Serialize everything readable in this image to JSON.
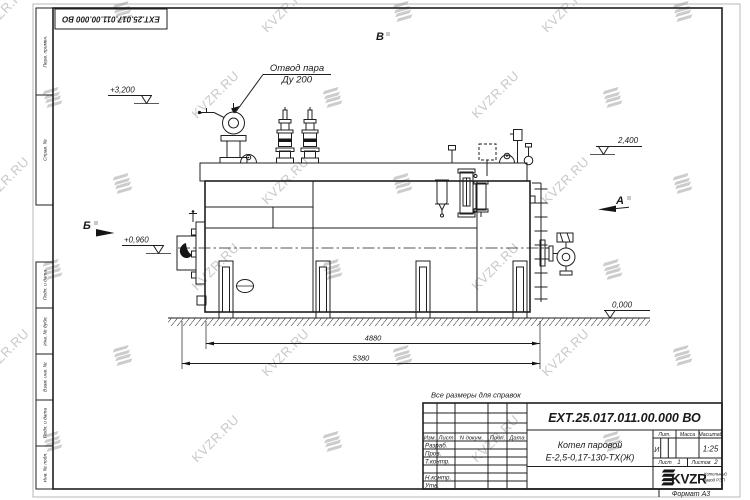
{
  "sheet": {
    "doc_number": "ЕХТ.25.017.011.00.000 ВО",
    "format_note": "Формат А3",
    "reference_note": "Все размеры для справок"
  },
  "drawing": {
    "callout_line1": "Отвод пара",
    "callout_line2": "Ду 200",
    "elev_top": "+3,200",
    "elev_burner": "+0,960",
    "elev_right": "2,400",
    "elev_zero": "0,000",
    "view_b": "Б",
    "view_v": "В",
    "view_a": "А",
    "dim_inner": "4880",
    "dim_overall": "5380"
  },
  "title_block": {
    "doc_number": "ЕХТ.25.017.011.00.000 ВО",
    "col_izm": "Изм.",
    "col_list": "Лист",
    "col_ndoc": "N докум.",
    "col_podp": "Подп.",
    "col_data": "Дата",
    "row_razrab": "Разраб.",
    "row_prov": "Пров.",
    "row_tkontr": "Т.контр.",
    "row_nkontr": "Н.контр.",
    "row_utv": "Утв.",
    "product_line1": "Котел паровой",
    "product_line2": "Е-2,5-0,17-130-ТХ(Ж)",
    "lit_label": "Лит.",
    "lit_value": "И",
    "mass_label": "Масса",
    "scale_label": "Масштаб",
    "scale_value": "1:25",
    "sheet_label": "Лист",
    "sheet_value": "1",
    "sheets_label": "Листов",
    "sheets_value": "2",
    "logo_text": "KVZR",
    "logo_sub1": "Котельный",
    "logo_sub2": "завод РЭП"
  },
  "frame_labels": {
    "items": [
      "Перв. примен.",
      "Справ. №",
      "Подп. и дата",
      "Инв. № дубл.",
      "Взам. инв. №",
      "Подп. и дата",
      "Инв. № подл."
    ]
  },
  "watermark": {
    "text": "KVZR.RU"
  }
}
